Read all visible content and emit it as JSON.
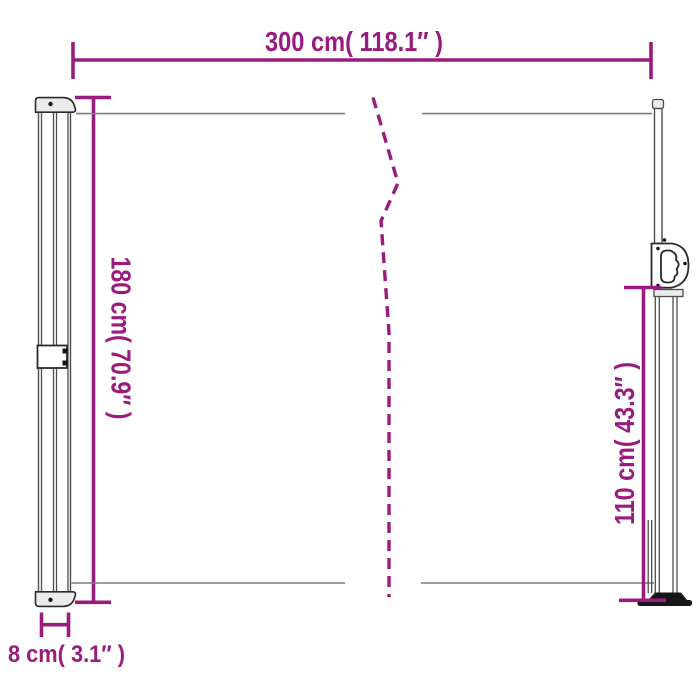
{
  "colors": {
    "dimension": "#9A1B7E",
    "outline": "#4D4D4D",
    "edge": "#2B2B2B",
    "fabric": "#7D7D7D",
    "dark": "#161616",
    "cap_fill": "#EBEBEB",
    "white": "#FFFFFF"
  },
  "dimensions": {
    "width": {
      "label": "300 cm( 118.1″ )"
    },
    "height": {
      "label": "180 cm( 70.9″ )"
    },
    "pole_height": {
      "label": "110 cm( 43.3″ )"
    },
    "depth": {
      "label": "8 cm( 3.1″ )"
    }
  }
}
